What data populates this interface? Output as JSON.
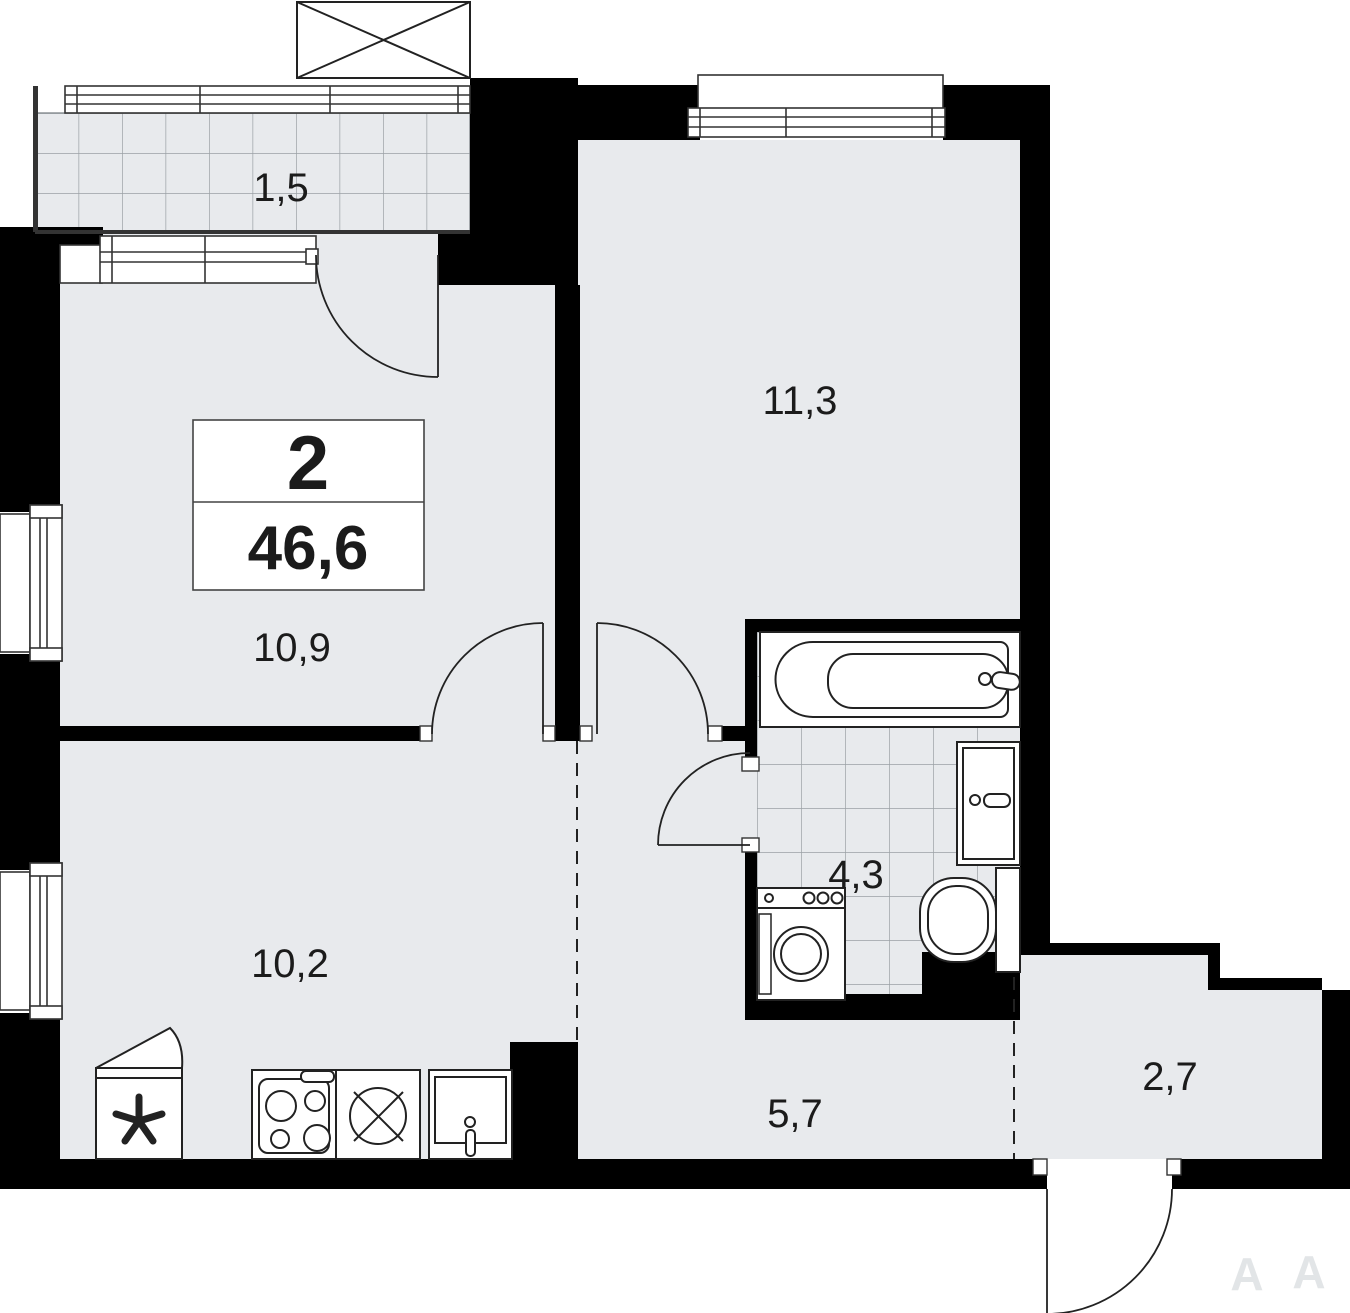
{
  "plan": {
    "info_box": {
      "rooms_count": "2",
      "total_area": "46,6"
    },
    "rooms": [
      {
        "id": "balcony",
        "area_label": "1,5"
      },
      {
        "id": "bedroom",
        "area_label": "11,3"
      },
      {
        "id": "living-room",
        "area_label": "10,9"
      },
      {
        "id": "kitchen",
        "area_label": "10,2"
      },
      {
        "id": "bathroom",
        "area_label": "4,3"
      },
      {
        "id": "hallway",
        "area_label": "5,7"
      },
      {
        "id": "entrance-hall",
        "area_label": "2,7"
      }
    ],
    "watermark": [
      "А",
      "А"
    ],
    "colors": {
      "wall": "#000000",
      "floor": "#e8eaed",
      "tile_line": "#9aa0a5",
      "fixture_stroke": "#222222"
    }
  }
}
